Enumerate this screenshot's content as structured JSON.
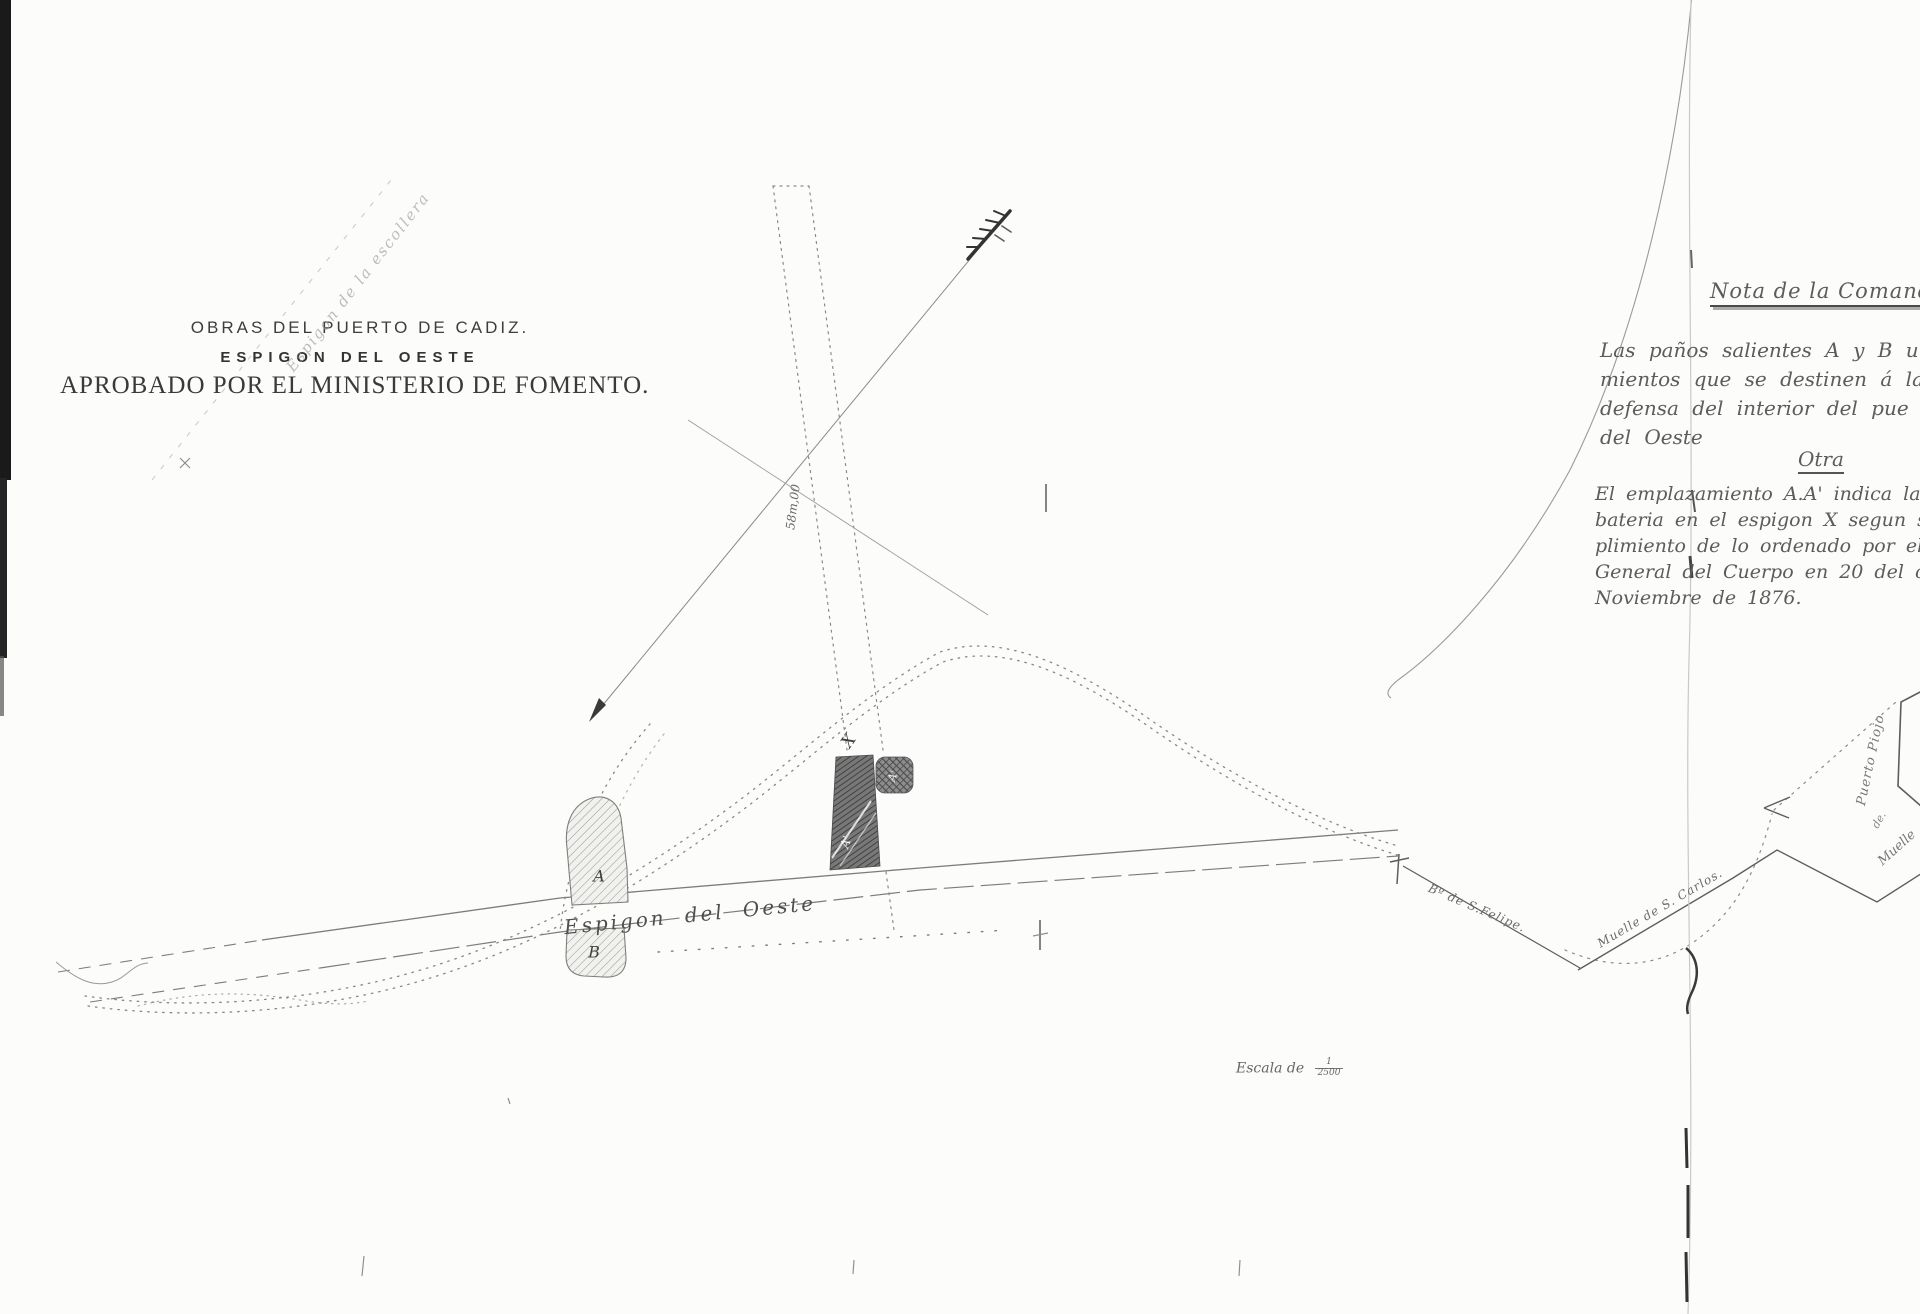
{
  "title_block": {
    "line1": "OBRAS DEL PUERTO DE CADIZ.",
    "line2": "ESPIGON DEL OESTE",
    "line3": "APROBADO POR EL MINISTERIO DE FOMENTO."
  },
  "handwritten_note": {
    "heading": "Nota de la Comanda",
    "para1_line1": "Las paños salientes A y B u",
    "para1_line2": "mientos que se destinen á la",
    "para1_line3": "defensa del interior del pue",
    "para1_line4": "del Oeste",
    "subheading": "Otra",
    "para2_line1": "El emplazamiento A.A' indica la",
    "para2_line2": "bateria en el espigon X segun se p",
    "para2_line3": "plimiento de lo ordenado por el Exm",
    "para2_line4": "General del Cuerpo en 20 del corrie",
    "para2_line5": "Noviembre de 1876."
  },
  "map_labels": {
    "espigon_oeste": "Espigon del Oeste",
    "espigon_faint": "Espigon de la escollera",
    "battery_a": "A",
    "battery_b": "B",
    "point_x": "X",
    "battery_a_prime_1": "A'",
    "battery_a_prime_2": "A'",
    "dimension_58m": "58m,00",
    "felipe": "Bº de S.Felipe.",
    "san_carlos": "Muelle de S. Carlos.",
    "puerto_piojo": "Puerto Piojo",
    "muelle_de": "de.",
    "muelle": "Muelle"
  },
  "scale": {
    "prefix": "Escala de",
    "numerator": "1",
    "denominator": "2500"
  },
  "ink_colors": {
    "title_ink": "#3d3d3d",
    "handwriting_ink": "#5c5c5c",
    "map_line": "#8a8a8a",
    "dark_structure": "#4f4f4f",
    "scan_edge": "#1a1a1a"
  }
}
